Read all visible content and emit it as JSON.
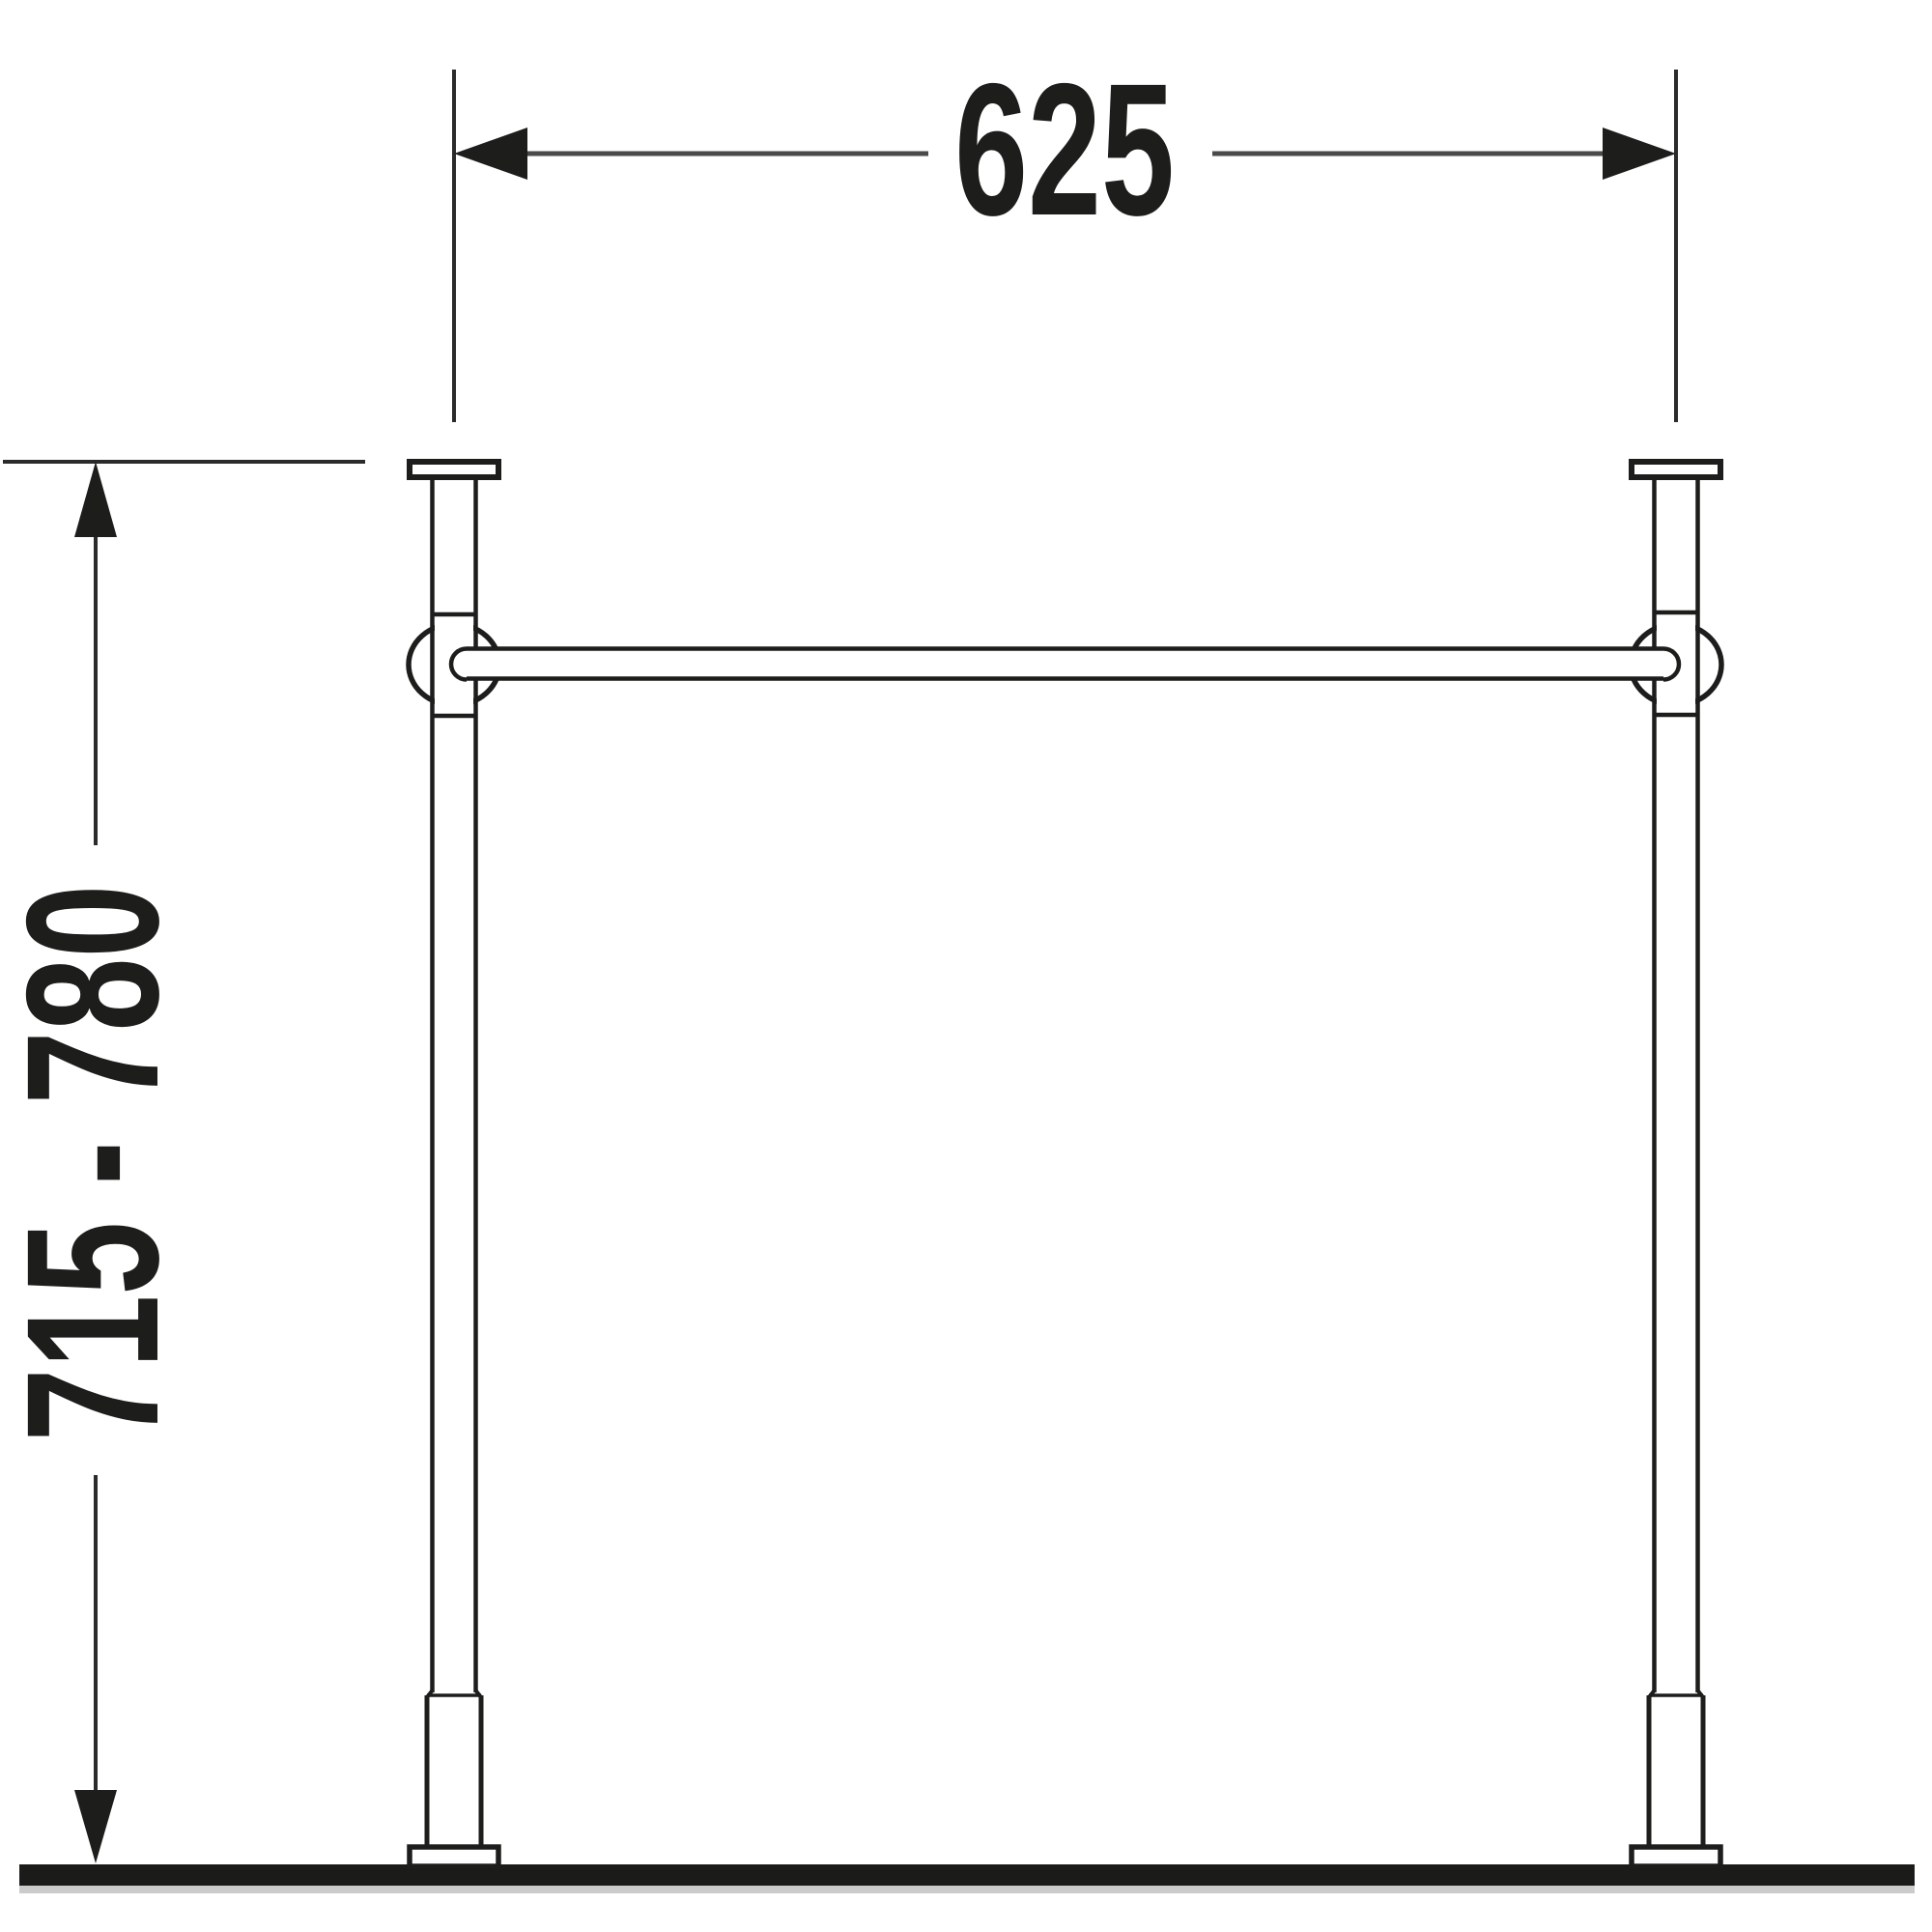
{
  "drawing": {
    "type": "technical dimension drawing, front elevation",
    "subject": "washbasin console stand: two legs with wall flanges, connecting towel rail, height-adjustable feet on floor line",
    "colors": {
      "background": "#ffffff",
      "structure_line": "#1d1d1b",
      "dimension_line": "#4a4a4a",
      "extension_line": "#2b2b2b",
      "label_text": "#1d1d1b",
      "floor": "#1b1b19",
      "floor_shadow": "#cbcbcb"
    },
    "dimensions": {
      "width": {
        "label": "625"
      },
      "height": {
        "label": "715 - 780"
      }
    },
    "components": {
      "left_leg": "console leg with wall flange, rail collar ring and adjustable foot",
      "right_leg": "console leg with wall flange, rail collar ring and adjustable foot",
      "rail": "horizontal connecting towel rail with rounded end caps",
      "floor": "floor / ground line"
    }
  }
}
